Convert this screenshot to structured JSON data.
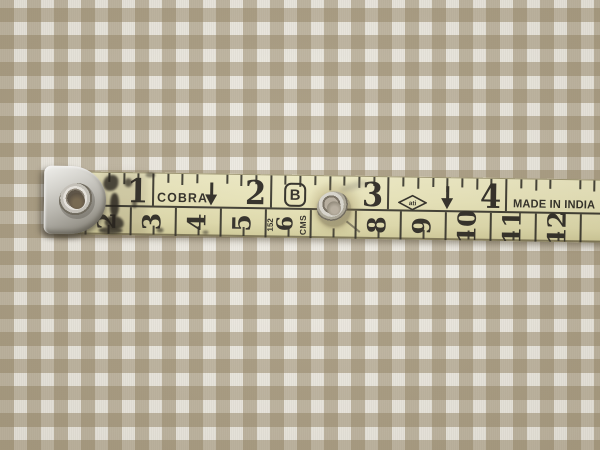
{
  "fabric": {
    "pattern": "gingham-check",
    "base_color": "#eeebe2",
    "stripe_color": "#948464",
    "check_size_px": 13
  },
  "tape": {
    "body_color": "#e7e3b8",
    "ink_color": "#2e2b24",
    "brand": "COBRA",
    "origin_label": "MADE IN INDIA",
    "logo_b": "B",
    "logo_diamond": "ati",
    "cluster": {
      "length": "152",
      "number": "6",
      "units": "CMS"
    },
    "inch_scale": {
      "numbers": [
        "1",
        "2",
        "3",
        "4"
      ],
      "ticks_per_inch": 8
    },
    "cm_scale": {
      "cells": [
        {
          "label": "2",
          "cell": 0
        },
        {
          "label": "3",
          "cell": 1
        },
        {
          "label": "4",
          "cell": 2
        },
        {
          "label": "5",
          "cell": 3
        },
        {
          "label": "8",
          "cell": 6
        },
        {
          "label": "9",
          "cell": 7
        },
        {
          "label": "10",
          "cell": 8
        },
        {
          "label": "11",
          "cell": 9
        },
        {
          "label": "12",
          "cell": 10
        }
      ]
    }
  },
  "icons": {
    "half_inch_marker": "down-arrow-icon",
    "end_fitting": "metal-end-tab",
    "fastener": "metal-rivet"
  }
}
